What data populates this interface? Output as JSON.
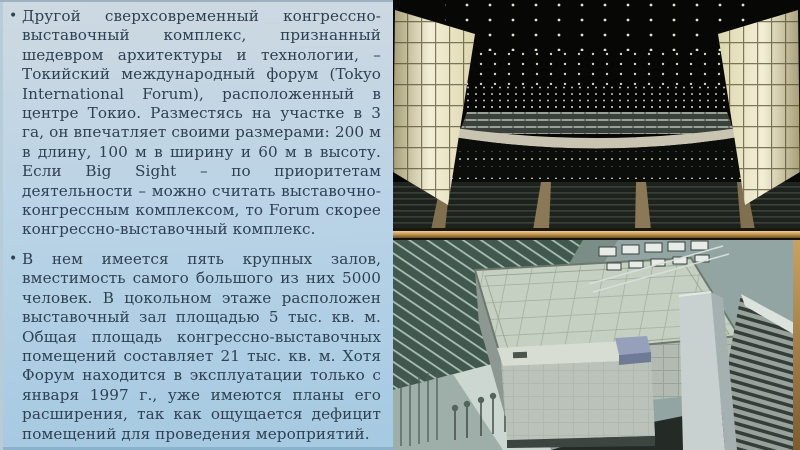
{
  "slide": {
    "bullet_char": "•",
    "paragraphs": [
      {
        "text": "Другой сверхсовременный конгрессно-выставочный комплекс, признанный шедевром архитектуры и технологии, – Токийский международный форум (Tokyo International Forum), расположенный в центре Токио. Разместясь на участке в 3 га, он впечатляет своими размерами: 200 м в длину, 100 м в ширину и 60 м в высоту. Если Big Sight – по приоритетам деятельности – можно считать выставочно-конгрессным комплексом, то Forum скорее конгрессно-выставочный комплекс."
      },
      {
        "text": "В нем имеется пять крупных залов, вместимость самого большого из них 5000 человек. В цокольном этаже расположен выставочный зал площадью 5 тыс. кв. м. Общая площадь конгрессно-выставочных помещений составляет 21 тыс. кв. м. Хотя Форум находится в эксплуатации только с января 1997 г., уже имеются планы его расширения, так как ощущается дефицит помещений для проведения мероприятий."
      }
    ],
    "photos": [
      {
        "id": "concert-hall-interior"
      },
      {
        "id": "tokyo-forum-aerial-view"
      }
    ],
    "colors": {
      "background_top": "#ced9e1",
      "background_bottom": "#a4c9e1",
      "text": "#2e4152",
      "stage_gold": "#c79a54",
      "hall_wall_glow": "#f3efd6",
      "roof_sage": "#c6d0c2"
    }
  }
}
